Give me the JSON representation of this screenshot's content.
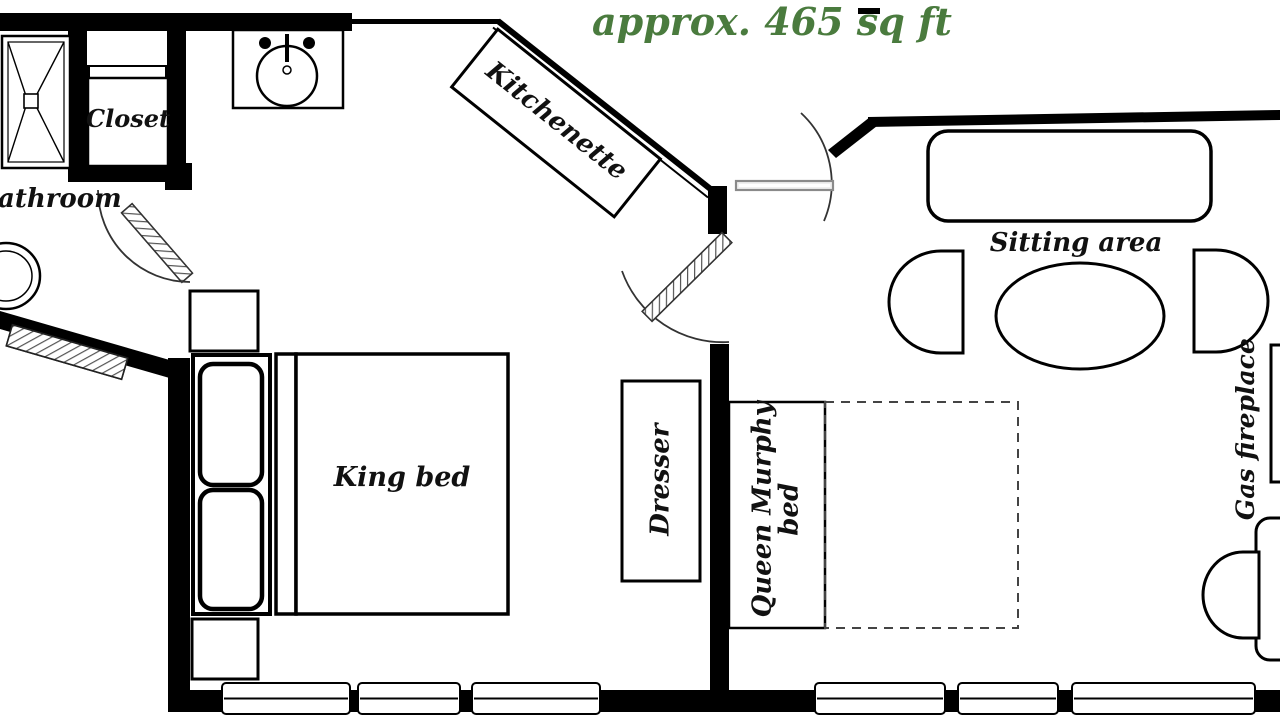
{
  "title": {
    "area_note": "approx. 465 sq ft"
  },
  "colors": {
    "accent_green": "#4a7b3e",
    "wall_black": "#000000",
    "door_gray": "#8a8a8a"
  },
  "rooms": {
    "bathroom": {
      "label": "Bathroom"
    },
    "closet": {
      "label": "Closet"
    },
    "kitchenette": {
      "label": "Kitchenette"
    },
    "sitting_area": {
      "label": "Sitting area"
    }
  },
  "furniture": {
    "king_bed": {
      "label": "King bed"
    },
    "dresser": {
      "label": "Dresser"
    },
    "queen_murphy_bed": {
      "lines": [
        "Queen Murphy",
        "bed"
      ]
    },
    "gas_fireplace": {
      "label": "Gas fireplace"
    }
  }
}
